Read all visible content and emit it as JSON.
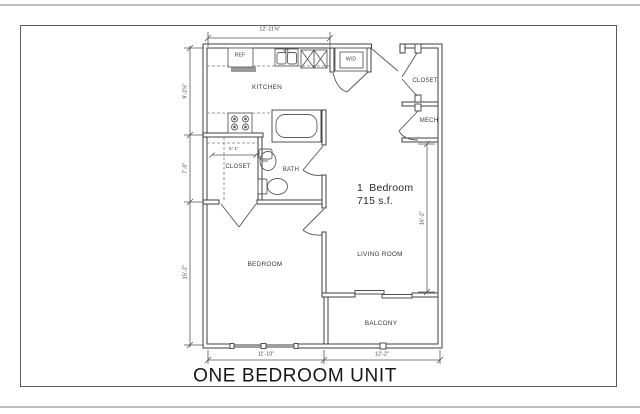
{
  "page": {
    "title": "ONE BEDROOM UNIT"
  },
  "unit": {
    "type": "1  Bedroom",
    "area": "715 s.f."
  },
  "rooms": {
    "kitchen": "KITCHEN",
    "entry_closet": "CLOSET",
    "mech": "MECH",
    "hall_closet": "CLOSET",
    "bath": "BATH",
    "bedroom": "BEDROOM",
    "living_room": "LIVING ROOM",
    "balcony": "BALCONY"
  },
  "fixtures": {
    "refrigerator": "REF",
    "washer_dryer": "W/D"
  },
  "dimensions": {
    "top": "12'-11⅝\"",
    "left_upper": "9'-2⅝\"",
    "left_mid": "7'-0\"",
    "left_lower": "15'-2\"",
    "hall_closet": "5'-1\"",
    "living": "16'-2\"",
    "bottom_left": "11'-10\"",
    "bottom_right": "12'-2\""
  },
  "colors": {
    "wall_line": "#3f3f3f",
    "fixture_line": "#5f5f5f",
    "dimension_line": "#555555",
    "page_edge": "#bfbfbf",
    "background": "#ffffff"
  }
}
